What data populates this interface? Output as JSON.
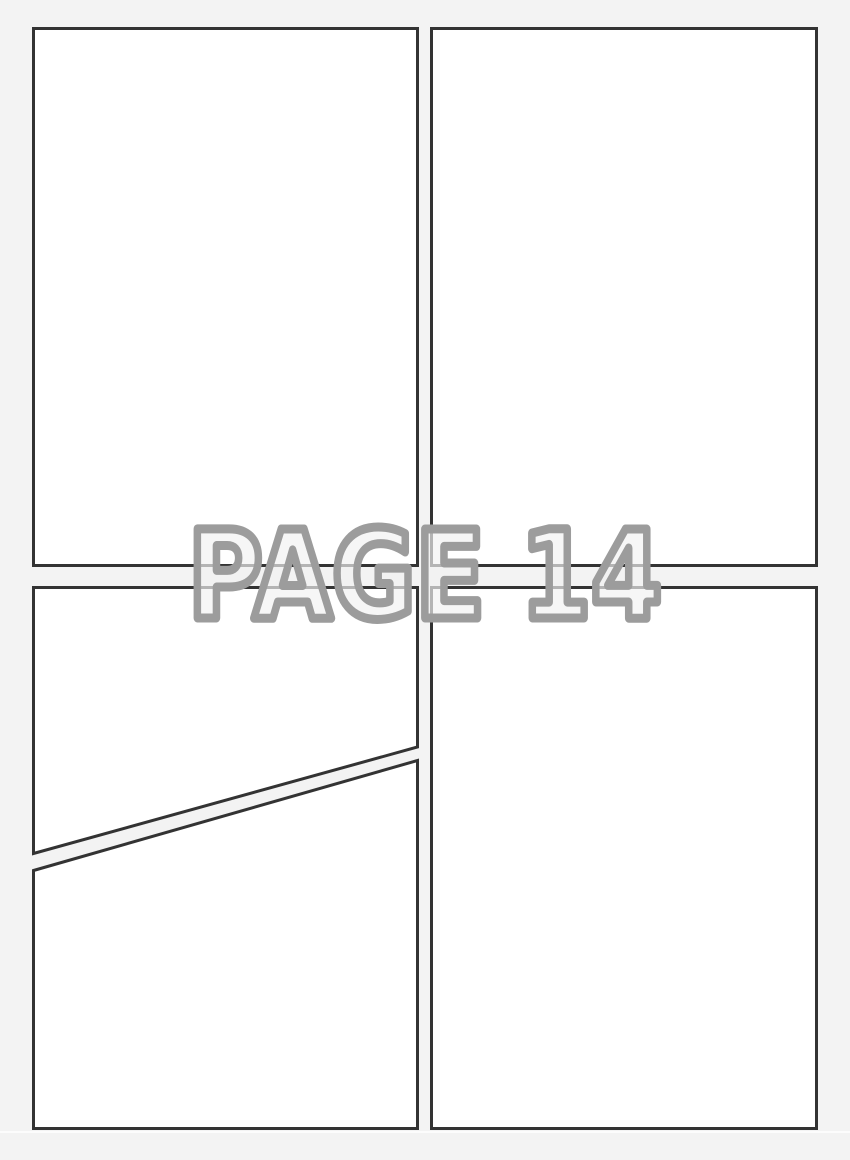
{
  "watermark": {
    "label": "PAGE 14"
  },
  "colors": {
    "background": "#f3f3f3",
    "panel_fill": "#ffffff",
    "panel_border": "#333333",
    "watermark_fill": "#f1f1f1",
    "watermark_outline": "#9c9c9c"
  },
  "panels": [
    {
      "id": "panel-top-left",
      "shape": "rectangle"
    },
    {
      "id": "panel-top-right",
      "shape": "rectangle"
    },
    {
      "id": "panel-bottom-left-upper",
      "shape": "diagonal-quad"
    },
    {
      "id": "panel-bottom-left-lower",
      "shape": "diagonal-quad"
    },
    {
      "id": "panel-bottom-right",
      "shape": "rectangle"
    }
  ]
}
